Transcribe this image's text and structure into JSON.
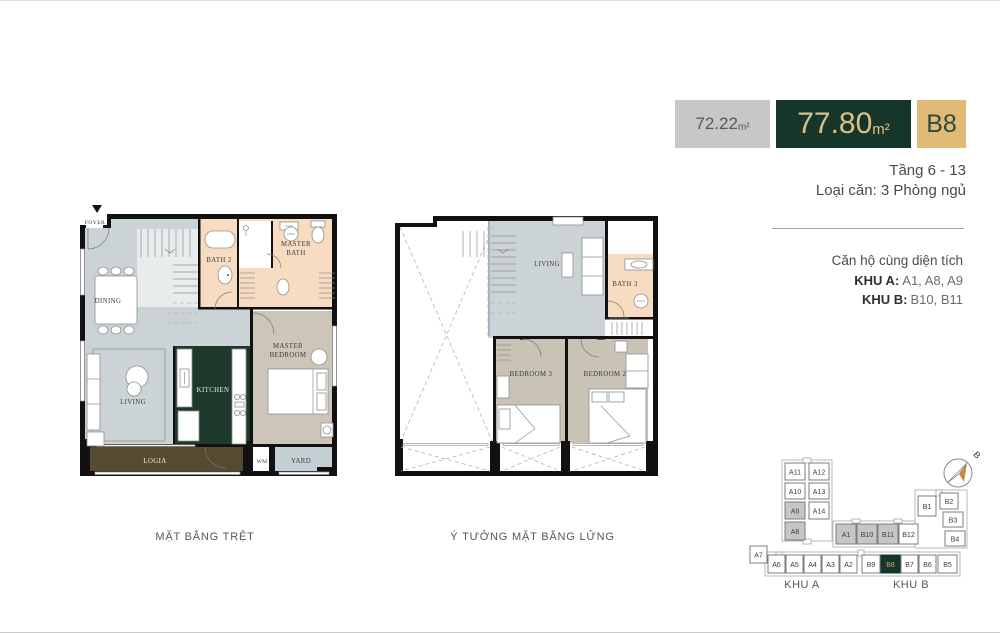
{
  "header": {
    "area_other": "72.22",
    "area_other_unit": "m²",
    "area_main": "77.80",
    "area_main_unit": "m²",
    "unit_code": "B8",
    "floor_range": "Tầng 6 - 13",
    "unit_type": "Loại căn: 3 Phòng ngủ"
  },
  "same_area": {
    "title": "Căn hộ cùng diện tích",
    "rows": [
      {
        "label": "KHU A:",
        "value": "A1, A8, A9"
      },
      {
        "label": "KHU B:",
        "value": "B10, B11"
      }
    ]
  },
  "ground_plan": {
    "caption": "MẶT BẰNG TRỆT",
    "labels": {
      "foyer": "FOYER",
      "dining": "DINING",
      "living": "LIVING",
      "kitchen": "KITCHEN",
      "bath2": "BATH 2",
      "master_bath": [
        "MASTER",
        "BATH"
      ],
      "master_bedroom": [
        "MASTER",
        "BEDROOM"
      ],
      "logia": "LOGIA",
      "wm": "WM",
      "yard": "YARD"
    }
  },
  "mezzanine_plan": {
    "caption": "Ý TƯỞNG MẶT BẰNG LỬNG",
    "labels": {
      "living": "LIVING",
      "bath3": "BATH 3",
      "bedroom3": "BEDROOM 3",
      "bedroom2": "BEDROOM 2"
    }
  },
  "keyplan": {
    "zone_a_label": "KHU A",
    "zone_b_label": "KHU B",
    "compass_label": "B",
    "units": [
      {
        "label": "A11",
        "state": ""
      },
      {
        "label": "A10",
        "state": ""
      },
      {
        "label": "A9",
        "state": "same"
      },
      {
        "label": "A8",
        "state": "same"
      },
      {
        "label": "A12",
        "state": ""
      },
      {
        "label": "A13",
        "state": ""
      },
      {
        "label": "A14",
        "state": ""
      },
      {
        "label": "A1",
        "state": "same"
      },
      {
        "label": "B10",
        "state": "same"
      },
      {
        "label": "B11",
        "state": "same"
      },
      {
        "label": "B12",
        "state": ""
      },
      {
        "label": "A7",
        "state": ""
      },
      {
        "label": "A6",
        "state": ""
      },
      {
        "label": "A5",
        "state": ""
      },
      {
        "label": "A4",
        "state": ""
      },
      {
        "label": "A3",
        "state": ""
      },
      {
        "label": "A2",
        "state": ""
      },
      {
        "label": "B9",
        "state": ""
      },
      {
        "label": "B8",
        "state": "current"
      },
      {
        "label": "B7",
        "state": ""
      },
      {
        "label": "B6",
        "state": ""
      },
      {
        "label": "B5",
        "state": ""
      },
      {
        "label": "B1",
        "state": ""
      },
      {
        "label": "B2",
        "state": ""
      },
      {
        "label": "B3",
        "state": ""
      },
      {
        "label": "B4",
        "state": ""
      }
    ]
  },
  "colors": {
    "accent_dark_green": "#17362b",
    "accent_gold": "#e0bb78",
    "muted_gray_box": "#c6c7c9",
    "floor_gray": "#ccd3d6",
    "floor_peach": "#f7dcc2",
    "floor_tan": "#cdc5b8",
    "kitchen_green": "#1d392c",
    "logia_brown": "#564a30",
    "wall_black": "#111111",
    "keyplan_same_gray": "#c6c6c6",
    "compass_orange": "#cd8a3c"
  }
}
